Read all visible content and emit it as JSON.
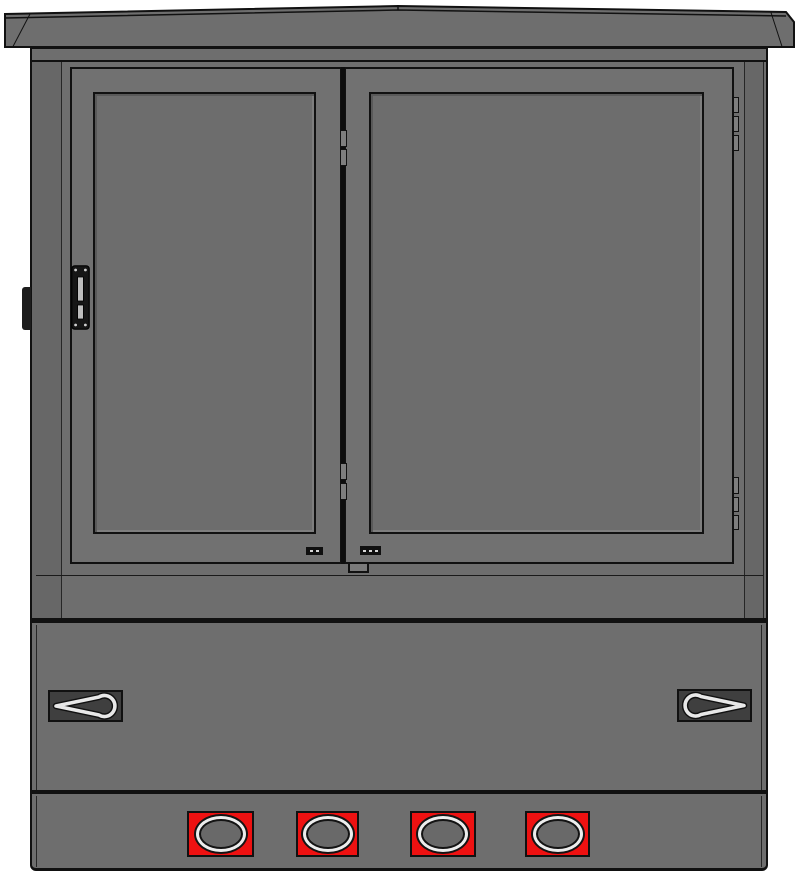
{
  "colors": {
    "background": "#ffffff",
    "cabinet_gray": "#6e6e6e",
    "side_gray": "#676767",
    "door_gray": "#717171",
    "panel_gray": "#6d6d6d",
    "outline": "#111111",
    "recess_dark": "#3f3f3f",
    "wire_light": "#e8e8e8",
    "port_red": "#ee1111",
    "ring_light": "#ededed",
    "slot_light": "#bdbdbd"
  },
  "ports": {
    "y": 811,
    "height": 46,
    "items": [
      {
        "x": 187,
        "width": 67
      },
      {
        "x": 296,
        "width": 63
      },
      {
        "x": 410,
        "width": 66
      },
      {
        "x": 525,
        "width": 65
      }
    ]
  },
  "hinges": {
    "center_column": {
      "x": 340,
      "width": 7,
      "segments": [
        {
          "y": 130,
          "h": 17
        },
        {
          "y": 149,
          "h": 17
        },
        {
          "y": 463,
          "h": 17
        },
        {
          "y": 483,
          "h": 17
        }
      ]
    },
    "right_column": {
      "x": 733,
      "width": 6,
      "segments": [
        {
          "y": 97,
          "h": 16
        },
        {
          "y": 116,
          "h": 16
        },
        {
          "y": 135,
          "h": 16
        },
        {
          "y": 477,
          "h": 17
        },
        {
          "y": 497,
          "h": 15
        },
        {
          "y": 515,
          "h": 15
        }
      ]
    }
  },
  "vents": [
    {
      "x": 306,
      "y": 547,
      "width": 17,
      "height": 8,
      "dots": 2
    },
    {
      "x": 360,
      "y": 546,
      "width": 21,
      "height": 9,
      "dots": 3
    }
  ]
}
